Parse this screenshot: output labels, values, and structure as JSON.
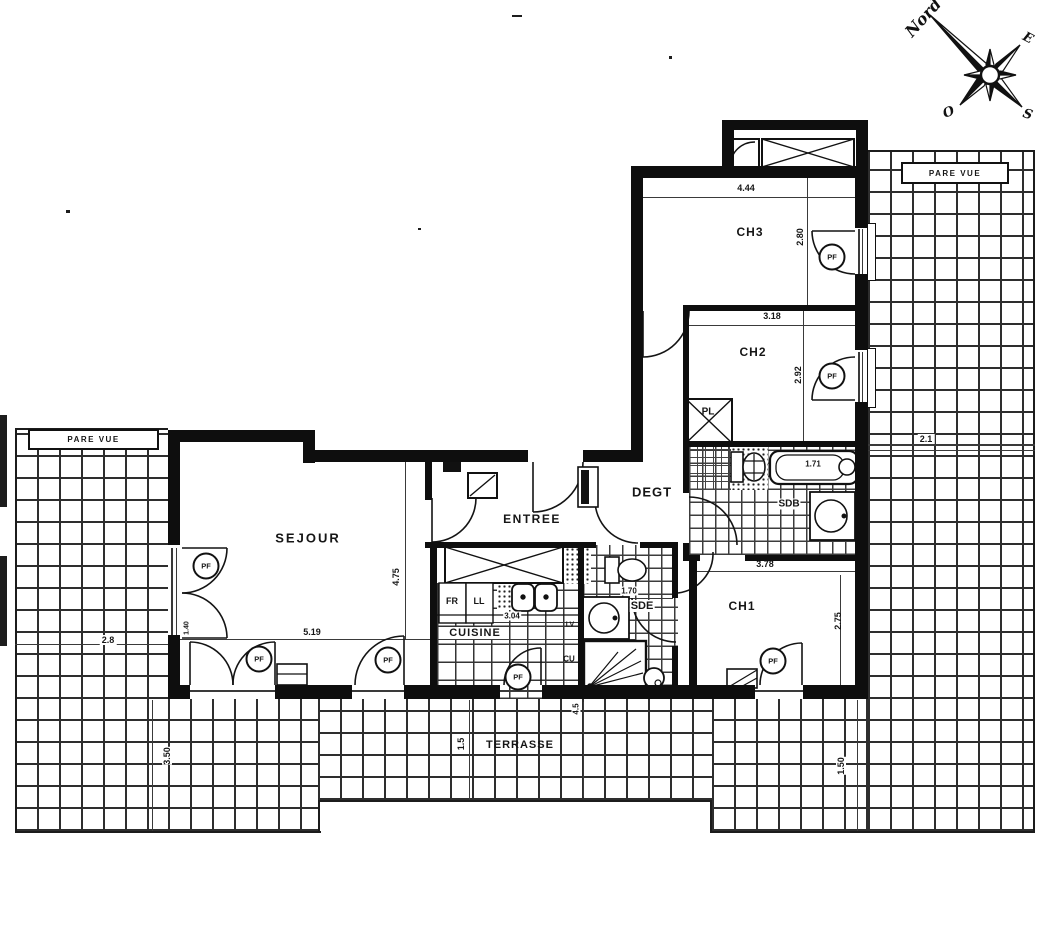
{
  "compass": {
    "north": "Nord",
    "east": "E",
    "south": "S",
    "west": "O"
  },
  "rooms": {
    "sejour": {
      "label": "SEJOUR",
      "width": "5.19",
      "height": "4.75"
    },
    "entree": {
      "label": "ENTREE"
    },
    "cuisine": {
      "label": "CUISINE",
      "width": "3.04"
    },
    "degagement": {
      "label": "DEGT"
    },
    "ch1": {
      "label": "CH1",
      "width": "3.78",
      "height": "2.75"
    },
    "ch2": {
      "label": "CH2",
      "width": "3.18",
      "height": "2.92"
    },
    "ch3": {
      "label": "CH3",
      "width": "4.44",
      "height": "2.80"
    },
    "sdb": {
      "label": "SDB",
      "bath_length": "1.71"
    },
    "sde": {
      "label": "SDE",
      "width": "1.70"
    },
    "placard": {
      "label": "PL"
    }
  },
  "terrace": {
    "label": "TERRASSE",
    "left_width": "2.8",
    "left_depth": "3.50",
    "bottom_depth": "1.5",
    "right_bottom_depth": "1.50",
    "right_width": "2.1",
    "sejour_step": "1.40",
    "kitchen_step": "4.5"
  },
  "screens": {
    "left": "PARE VUE",
    "right": "PARE VUE"
  },
  "appliances": {
    "fridge": "FR",
    "washer": "LL",
    "dishwasher": "LV",
    "water_heater": "CU"
  },
  "marks": {
    "window": "PF"
  }
}
